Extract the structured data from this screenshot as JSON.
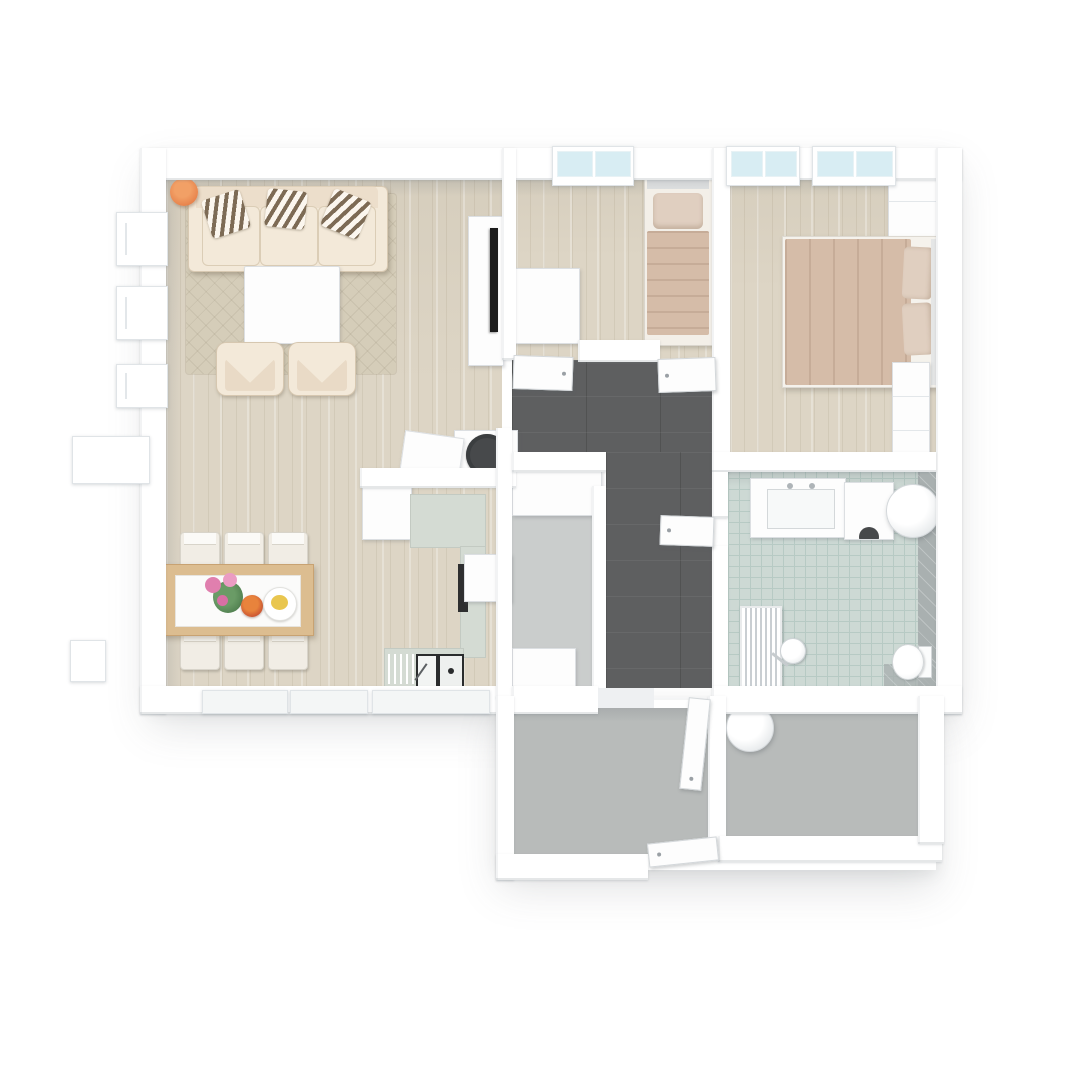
{
  "meta": {
    "title": "3D rendered apartment floor plan (top-down view)",
    "view": "top-down 3D render",
    "visible_text": "none"
  },
  "colors": {
    "wall": "#ffffff",
    "wallshade": "#eef0f2",
    "wood": "#ddd5c5",
    "rug": "#d5cdb9",
    "hall": "#5e5f60",
    "bath": "#cdd9d4",
    "bathline": "#b7cac4",
    "bathwalltile": "#a9b0b0",
    "gray": "#b8bbba",
    "pantry": "#cacdcc",
    "sage": "#d4dbd3",
    "cream": "#f3e9d9",
    "creamdark": "#e6d6c0",
    "stripe": "#7d6b55",
    "tan": "#d5bca8",
    "tanlight": "#e0cfc0",
    "tablewood": "#dcbd90",
    "chair": "#f1ede5",
    "glass": "#d8edf3",
    "dark": "#47494b",
    "black": "#1c1c1c",
    "orange": "#e8854e",
    "green": "#4e7d4e",
    "pink": "#e07fae",
    "red": "#c2452e",
    "yellow": "#e9c64f"
  },
  "rooms": [
    {
      "id": "living-dining",
      "floor": "light wood planks",
      "contents": [
        "sofa with 3 striped pillows",
        "beige diamond rug",
        "white coffee table",
        "2 cream armchairs",
        "orange plant pot",
        "TV cabinet with TV",
        "dining table with flowers, bowl and plate",
        "6 white chairs",
        "L-shaped kitchen with sink, cooktop, round basin"
      ]
    },
    {
      "id": "small-bedroom",
      "floor": "light wood planks",
      "contents": [
        "single bed with tan blanket",
        "white desk"
      ]
    },
    {
      "id": "master-bedroom",
      "floor": "light wood planks",
      "contents": [
        "double bed with tan duvet and 2 pillows",
        "wardrobe",
        "chest of drawers"
      ]
    },
    {
      "id": "hallway",
      "floor": "dark gray tile",
      "contents": [
        "4 white doors"
      ]
    },
    {
      "id": "storage-closet",
      "floor": "light gray",
      "contents": [
        "white closet",
        "white cabinet"
      ]
    },
    {
      "id": "bathroom",
      "floor": "mint square tile",
      "contents": [
        "vanity with sink",
        "washing machine",
        "water heater cylinder",
        "toilet",
        "towel radiator",
        "shower head"
      ]
    },
    {
      "id": "entry-porch",
      "floor": "gray concrete",
      "contents": [
        "open entry door"
      ]
    },
    {
      "id": "storage-room",
      "floor": "gray concrete",
      "contents": [
        "water heater cylinder"
      ]
    }
  ],
  "windows": {
    "top": 3,
    "left": 3,
    "bottom": 3,
    "exterior_platforms": 2
  }
}
